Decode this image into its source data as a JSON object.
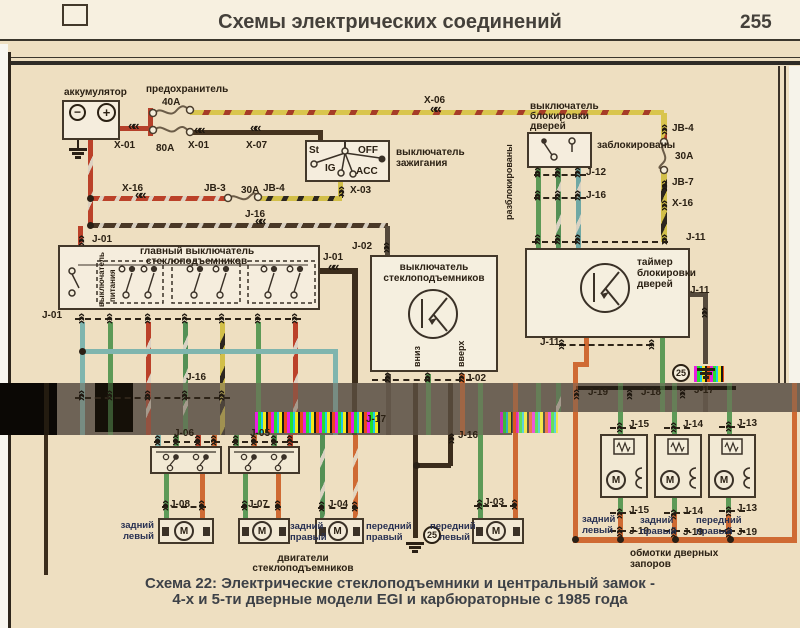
{
  "header": {
    "title": "Схемы электрических соединений",
    "page_number": "255"
  },
  "caption": {
    "line1": "Схема 22: Электрические стеклоподъемники и центральный замок  -",
    "line2": "4-х и 5-ти дверные модели EGI и карбюраторные с 1985 года"
  },
  "colors": {
    "paper": "#eedfc1",
    "band": "#6e6356",
    "wire_red": "#b5402a",
    "wire_yellow": "#d9c54d",
    "wire_green": "#5d9a57",
    "wire_teal": "#7fb5ae",
    "wire_orange": "#cf6a33",
    "wire_brown": "#45331f",
    "label_text": "#2b2114"
  },
  "battery": {
    "label": "аккумулятор",
    "minus": "−",
    "plus": "+"
  },
  "fuses": {
    "label": "предохранитель",
    "f40": "40A",
    "f80": "80A"
  },
  "ignition": {
    "line1": "выключатель",
    "line2": "зажигания",
    "st": "St",
    "off": "OFF",
    "ig": "IG",
    "acc": "ACC"
  },
  "door_lock_switch": {
    "line1": "выключатель",
    "line2": "блокировки",
    "line3": "дверей",
    "unlocked": "разблокированы",
    "locked": "заблокированы"
  },
  "main_switch": {
    "line1": "главный выключатель",
    "line2": "стеклоподъемников",
    "power1": "выключатель",
    "power2": "питания"
  },
  "window_switch": {
    "line1": "выключатель",
    "line2": "стеклоподъемников",
    "down": "вниз",
    "up": "вверх"
  },
  "timer": {
    "line1": "таймер",
    "line2": "блокировки",
    "line3": "дверей"
  },
  "motors": {
    "cap1": "двигатели",
    "cap2": "стеклоподъемников",
    "symbol": "М",
    "items": [
      {
        "connector": "J-08",
        "pos1": "задний",
        "pos2": "левый"
      },
      {
        "connector": "J-07",
        "pos1": "задний",
        "pos2": "правый"
      },
      {
        "connector": "J-04",
        "pos1": "передний",
        "pos2": "правый"
      },
      {
        "connector": "J-03",
        "pos1": "передний",
        "pos2": "левый"
      }
    ]
  },
  "door_locks": {
    "cap1": "обмотки дверных",
    "cap2": "запоров",
    "items": [
      {
        "top": "J-15",
        "pos1": "задний",
        "pos2": "левый"
      },
      {
        "top": "J-14",
        "pos1": "задний",
        "pos2": "правый"
      },
      {
        "top": "J-13",
        "pos1": "передний",
        "pos2": "правый"
      }
    ]
  },
  "ground_ref": "25",
  "connector_labels": [
    {
      "t": "X-01",
      "x": 114,
      "y": 140
    },
    {
      "t": "X-01",
      "x": 188,
      "y": 140
    },
    {
      "t": "X-07",
      "x": 246,
      "y": 140
    },
    {
      "t": "X-06",
      "x": 424,
      "y": 95
    },
    {
      "t": "X-03",
      "x": 350,
      "y": 185
    },
    {
      "t": "X-16",
      "x": 122,
      "y": 183
    },
    {
      "t": "JB-3",
      "x": 204,
      "y": 183
    },
    {
      "t": "30A",
      "x": 241,
      "y": 185
    },
    {
      "t": "JB-4",
      "x": 263,
      "y": 183
    },
    {
      "t": "J-16",
      "x": 245,
      "y": 209
    },
    {
      "t": "J-01",
      "x": 92,
      "y": 234
    },
    {
      "t": "J-01",
      "x": 323,
      "y": 252
    },
    {
      "t": "J-01",
      "x": 42,
      "y": 310
    },
    {
      "t": "J-02",
      "x": 352,
      "y": 241
    },
    {
      "t": "J-02",
      "x": 466,
      "y": 373
    },
    {
      "t": "JB-4",
      "x": 672,
      "y": 123
    },
    {
      "t": "30A",
      "x": 675,
      "y": 151
    },
    {
      "t": "JB-7",
      "x": 672,
      "y": 177
    },
    {
      "t": "X-16",
      "x": 672,
      "y": 198
    },
    {
      "t": "J-12",
      "x": 586,
      "y": 167
    },
    {
      "t": "J-16",
      "x": 586,
      "y": 190
    },
    {
      "t": "J-11",
      "x": 686,
      "y": 232
    },
    {
      "t": "J-11",
      "x": 690,
      "y": 285
    },
    {
      "t": "J-11",
      "x": 540,
      "y": 337
    },
    {
      "t": "J-19",
      "x": 588,
      "y": 387
    },
    {
      "t": "J-18",
      "x": 641,
      "y": 387
    },
    {
      "t": "J-17",
      "x": 694,
      "y": 385
    },
    {
      "t": "J-16",
      "x": 186,
      "y": 372
    },
    {
      "t": "J-17",
      "x": 366,
      "y": 414
    },
    {
      "t": "J-06",
      "x": 174,
      "y": 428
    },
    {
      "t": "J-05",
      "x": 250,
      "y": 428
    },
    {
      "t": "J-16",
      "x": 458,
      "y": 430
    },
    {
      "t": "J-15",
      "x": 629,
      "y": 419
    },
    {
      "t": "J-14",
      "x": 683,
      "y": 419
    },
    {
      "t": "J-13",
      "x": 737,
      "y": 418
    },
    {
      "t": "J-08",
      "x": 170,
      "y": 499
    },
    {
      "t": "J-07",
      "x": 248,
      "y": 499
    },
    {
      "t": "J-04",
      "x": 328,
      "y": 499
    },
    {
      "t": "J-03",
      "x": 484,
      "y": 497
    },
    {
      "t": "J-15",
      "x": 629,
      "y": 505
    },
    {
      "t": "J-14",
      "x": 683,
      "y": 506
    },
    {
      "t": "J-13",
      "x": 737,
      "y": 503
    },
    {
      "t": "J-19",
      "x": 629,
      "y": 526
    },
    {
      "t": "J-19",
      "x": 683,
      "y": 527
    },
    {
      "t": "J-19",
      "x": 737,
      "y": 527
    }
  ]
}
